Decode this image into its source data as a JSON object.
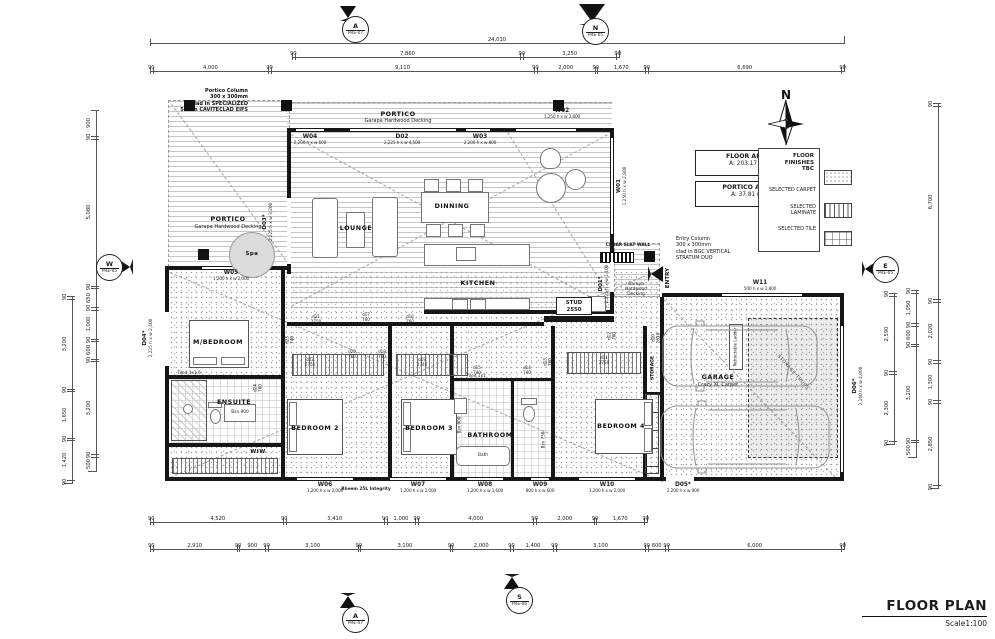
{
  "sheet": {
    "title": "FLOOR PLAN",
    "scale": "Scale1:100"
  },
  "compass": {
    "letter": "N"
  },
  "area_boxes": {
    "floor_title": "FLOOR AREA",
    "floor_value": "A:  203.17 m²",
    "portico_title": "PORTICO AREA",
    "portico_value": "A:        37.81 m²"
  },
  "finishes": {
    "title": "FLOOR FINISHES",
    "status": "TBC",
    "carpet": "SELECTED CARPET",
    "laminate": "SELECTED LAMINATE",
    "tile": "SELECTED TILE"
  },
  "notes": {
    "portico_column": "Portico Column\n300 x 300mm\nclad in SPECIALIZED\n50mm CAVITECLAD EIFS",
    "entry_column": "Entry Column\n300 x 300mm\nclad in BGC VERTICAL\nSTRATUM DUO",
    "cedar_wall": "CEDAR SLAT WALL",
    "entry": "ENTRY",
    "stud": "STUD\n2550",
    "rheem": "Rheem 25L Integrity",
    "ladder": "Retractable Ladder",
    "truss": "STORAGE TRUSS",
    "entry_deck": "Garapa\nHardwood\nDecking"
  },
  "rooms": {
    "portico_top_name": "PORTICO",
    "portico_top_sub": "Garapa Hardwood Decking",
    "portico_left_name": "PORTICO",
    "portico_left_sub": "Garapa Hardwood Decking",
    "lounge": "LOUNGE",
    "dining": "DINNING",
    "kitchen": "KITCHEN",
    "mbed": "M/BEDROOM",
    "ensuite": "ENSUITE",
    "wiw": "WIW",
    "bed2": "BEDROOM 2",
    "bed3": "BEDROOM 3",
    "bath": "BATHROOM",
    "bed4": "BEDROOM 4",
    "garage_name": "GARAGE",
    "garage_sub": "Crazy XL Carpet",
    "storage": "STORAGE",
    "spa": "Spa",
    "bath_tub": "Bath",
    "tiled_1x1": "Tiled 1x1",
    "tiled_1x16": "Tiled 1x1.6",
    "bsn900_bath": "Bsn 900",
    "bsn900_ens": "Bsn 900",
    "bsn750": "Bsn 750"
  },
  "openings": {
    "w01": {
      "id": "W01",
      "size": "1,250 h x w 2,800"
    },
    "w02": {
      "id": "W02",
      "size": "1,250 h x w 2,800"
    },
    "w03": {
      "id": "W03",
      "size": "2,200 h x w 800"
    },
    "w04": {
      "id": "W04",
      "size": "2,200 h x w 600"
    },
    "w05": {
      "id": "W05",
      "size": "1,200 h x w 2,000"
    },
    "w06": {
      "id": "W06",
      "size": "1,200 h x w 2,000"
    },
    "w07": {
      "id": "W07",
      "size": "1,200 h x w 2,000"
    },
    "w08": {
      "id": "W08",
      "size": "1,200 h x w 1,600"
    },
    "w09": {
      "id": "W09",
      "size": "800 h x w 600"
    },
    "w10": {
      "id": "W10",
      "size": "1,200 h x w 2,000"
    },
    "w11": {
      "id": "W11",
      "size": "500 h x w 2,800"
    },
    "d01": {
      "id": "D01*",
      "size": "2,225 h x w 1,100"
    },
    "d02": {
      "id": "D02",
      "size": "2,225 h x w 4,500"
    },
    "d03": {
      "id": "D03*",
      "size": "2,225 h x w 3,200"
    },
    "d04": {
      "id": "D04*",
      "size": "2,225 h x w 2,400"
    },
    "d05": {
      "id": "D05*",
      "size": "2,200 h x w 900"
    },
    "d06": {
      "id": "D06*",
      "size": "2,160 h x w 4,800"
    }
  },
  "door_tags": {
    "d10": "d10\n2616",
    "d11": "d11\n2750",
    "d12": "d12\n760",
    "d13": "d13\n760",
    "d14": "d14\n740",
    "d15": "d15\n740",
    "d16": "d16\n760",
    "d17": "d17\n760",
    "d18": "d18\n760",
    "d19": "d19\n2740",
    "d20": "d20\n760",
    "d21": "d21\n2750",
    "d22": "d22\n2750",
    "d23": "d23\n740",
    "d24": "d24\n760"
  },
  "markers": {
    "top_a": {
      "letter": "A",
      "ref": "PRE-07"
    },
    "top_n": {
      "letter": "N",
      "ref": "PRE-05"
    },
    "left_w": {
      "letter": "W",
      "ref": "PRE-05"
    },
    "right_e": {
      "letter": "E",
      "ref": "PRE-05"
    },
    "bottom_a": {
      "letter": "A",
      "ref": "PRE-07"
    },
    "bottom_s": {
      "letter": "S",
      "ref": "PRE-06"
    }
  },
  "dims": {
    "overall": [
      "24,010"
    ],
    "top2": [
      "90",
      "7,860",
      "90",
      "3,250",
      "90"
    ],
    "top3": [
      "90",
      "4,000",
      "90",
      "9,110",
      "90",
      "2,000",
      "90",
      "1,670",
      "90",
      "6,690",
      "90"
    ],
    "bottom1": [
      "90",
      "4,520",
      "90",
      "3,410",
      "90",
      "1,000",
      "90",
      "4,000",
      "90",
      "2,000",
      "90",
      "1,670",
      "90"
    ],
    "bottom2": [
      "90",
      "2,910",
      "90",
      "900",
      "90",
      "3,100",
      "90",
      "3,100",
      "90",
      "2,000",
      "90",
      "1,400",
      "90",
      "3,100",
      "90",
      "600",
      "90",
      "6,000",
      "90"
    ],
    "left_outer": [
      "90",
      "3,200",
      "90",
      "1,650",
      "90",
      "1,420",
      "90"
    ],
    "left_inner": [
      "900",
      "90",
      "5,080",
      "90",
      "650",
      "90",
      "1,000",
      "90",
      "600",
      "90",
      "3,200",
      "90",
      "500"
    ],
    "right_outer": [
      "90",
      "6,700",
      "90",
      "2,020",
      "90",
      "1,300",
      "90",
      "2,850",
      "90"
    ],
    "right_mid": [
      "90",
      "1,050",
      "90",
      "600",
      "90",
      "3,200",
      "90",
      "500"
    ],
    "right_inner": [
      "90",
      "2,590",
      "90",
      "2,300",
      "90"
    ]
  }
}
